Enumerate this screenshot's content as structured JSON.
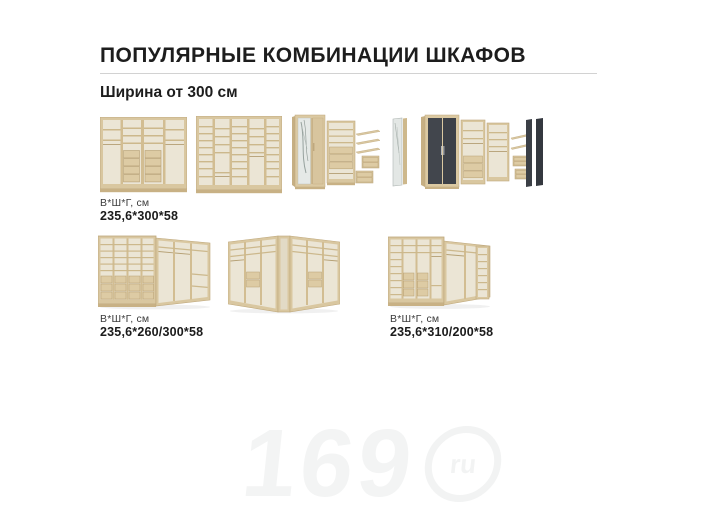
{
  "page": {
    "title": "ПОПУЛЯРНЫЕ КОМБИНАЦИИ ШКАФОВ",
    "subtitle": "Ширина от 300 см"
  },
  "row1": {
    "label": {
      "caption": "В*Ш*Г, см",
      "value": "235,6*300*58"
    }
  },
  "row2": {
    "labels": [
      {
        "caption": "В*Ш*Г, см",
        "value": "235,6*260/300*58"
      },
      {
        "caption": "В*Ш*Г, см",
        "value": "235,6*310/200*58"
      }
    ]
  },
  "watermark": {
    "digits": "169",
    "circle_text": "ru"
  },
  "colors": {
    "wood": "#d9c7a0",
    "wood_dark": "#c8b185",
    "interior": "#ebe5d5",
    "shelf_line": "#ccb88c",
    "drawer": "#ddcba4",
    "dark_door": "#42464d",
    "mirror": "#e5e9e7",
    "divider_line": "#d2d2d2",
    "watermark": "#f2f3f3"
  }
}
